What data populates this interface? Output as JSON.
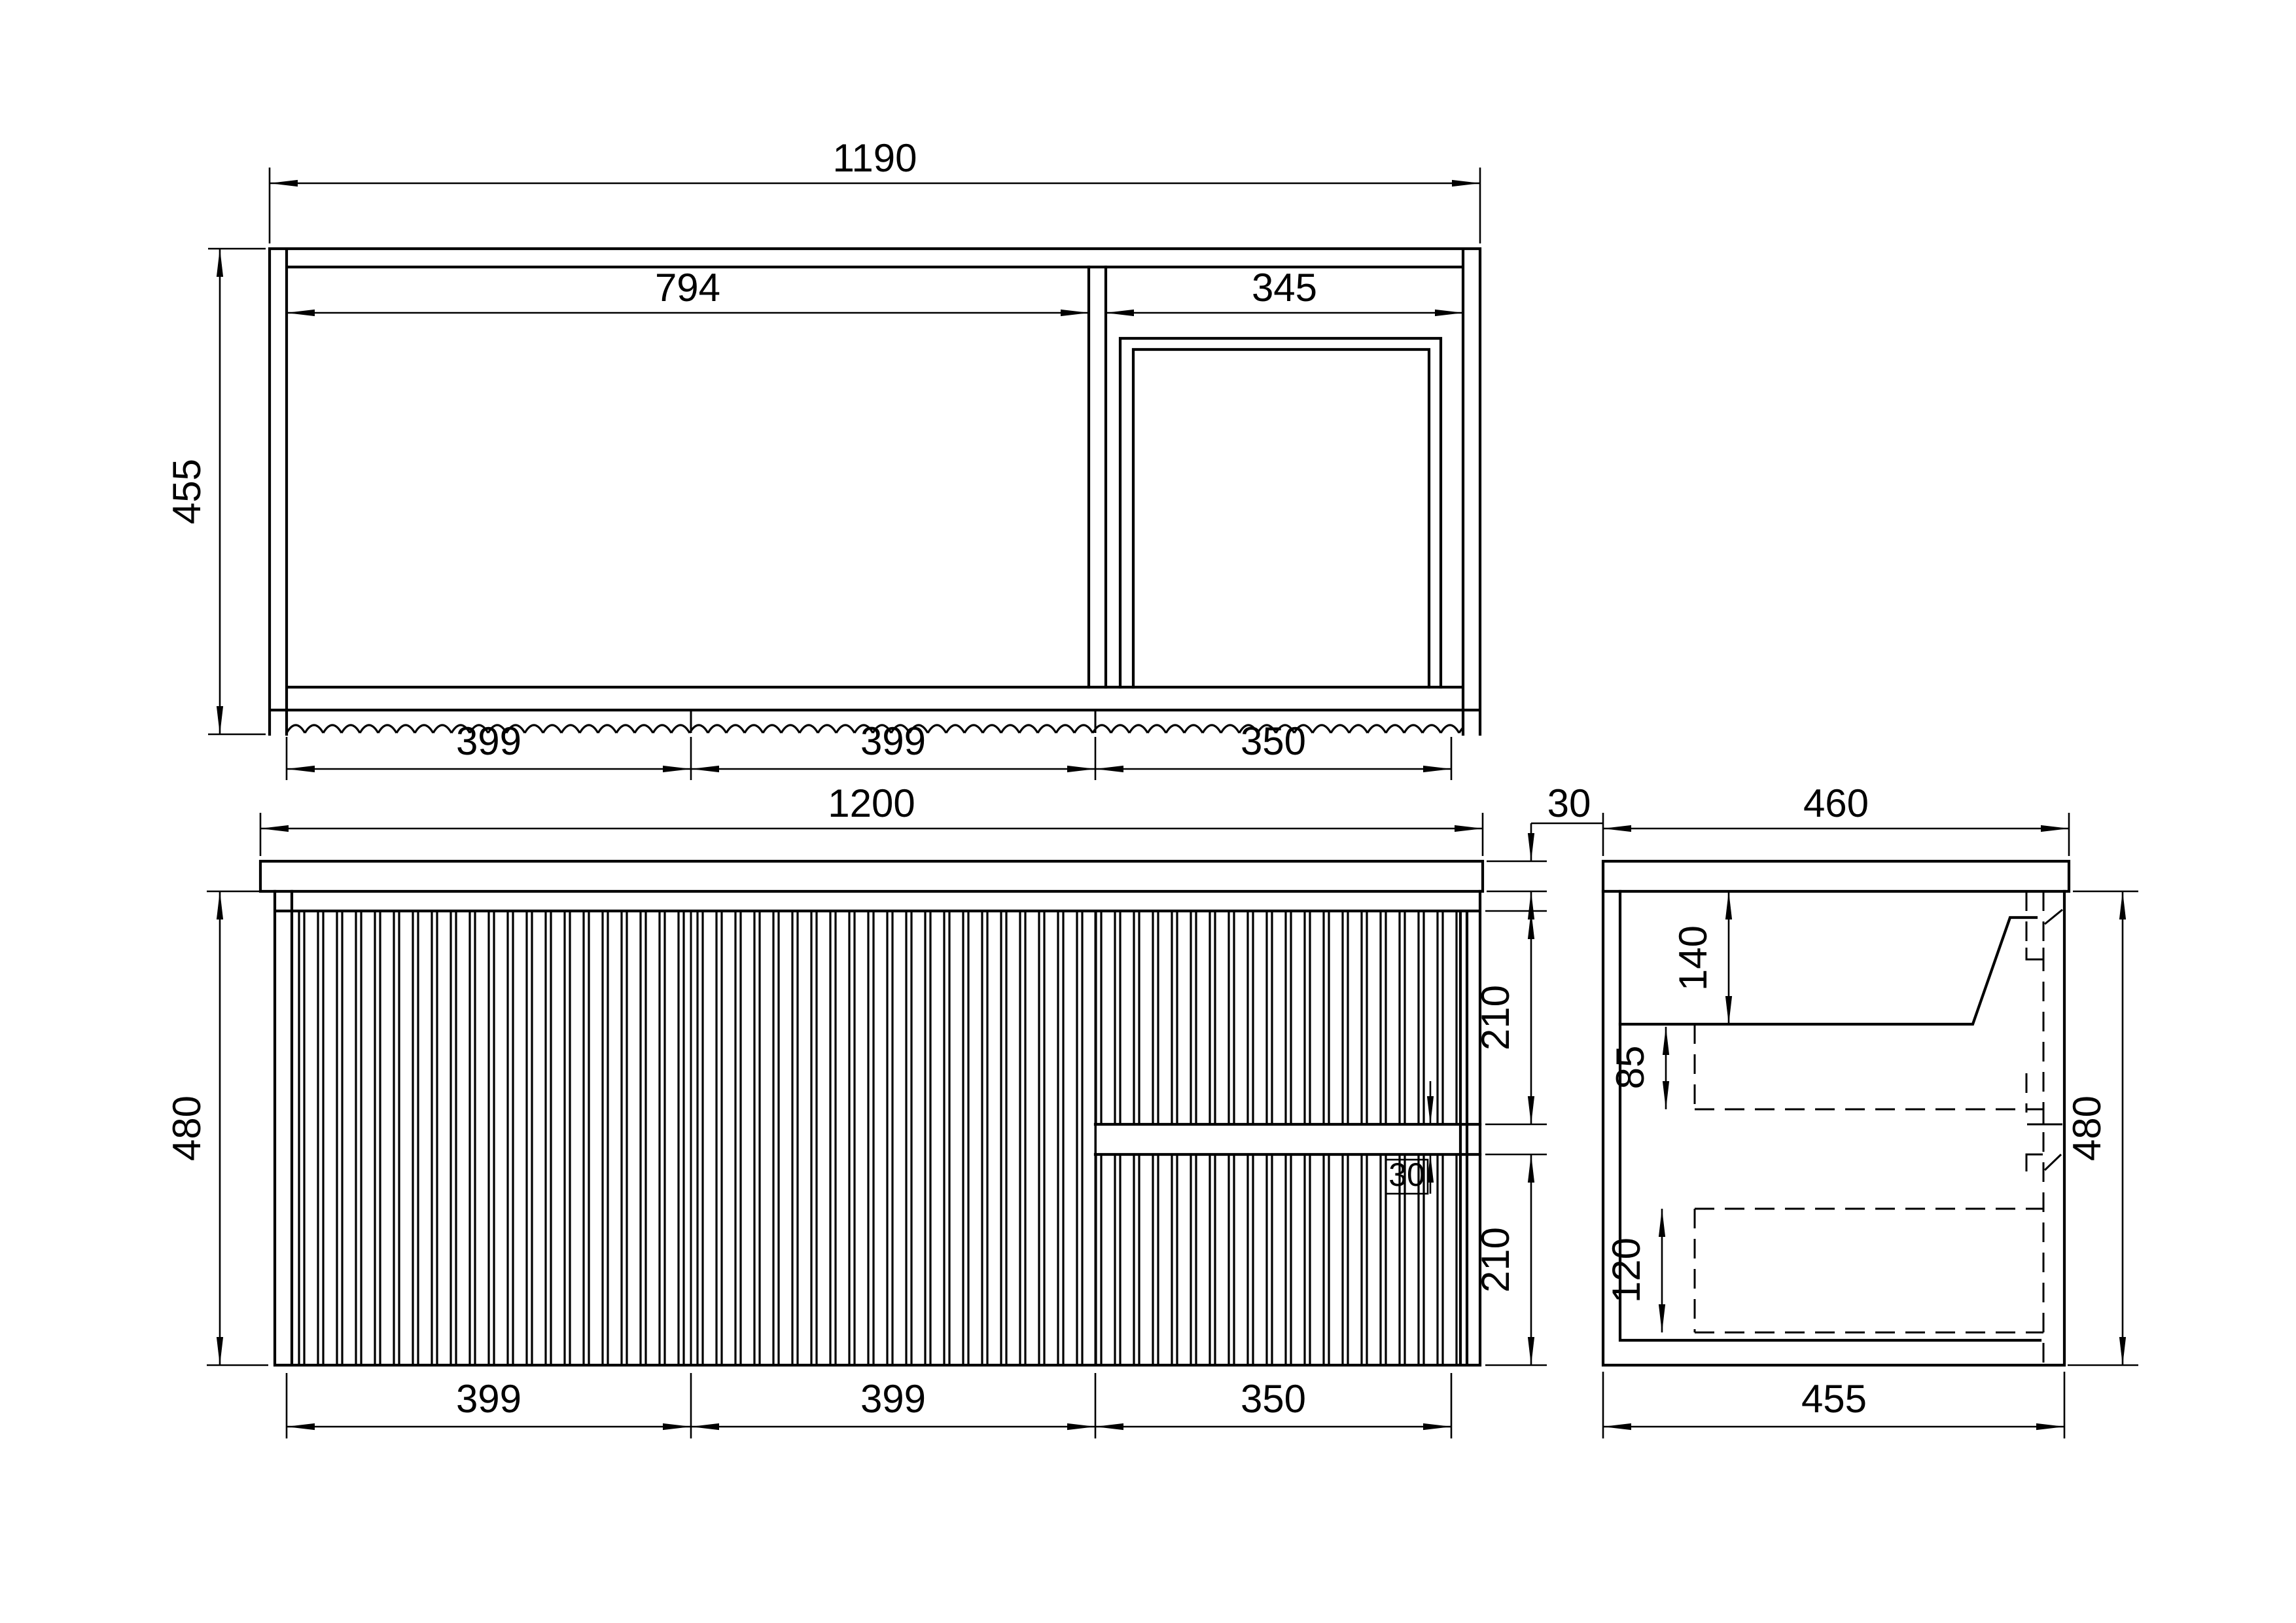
{
  "drawing": {
    "style": {
      "line_color": "#000000",
      "background": "#ffffff"
    },
    "views": {
      "plan": {
        "dims": {
          "overall_width": "1190",
          "opening_left": "794",
          "opening_right": "345",
          "depth": "455",
          "segment_left": "399",
          "segment_mid": "399",
          "segment_right": "350"
        }
      },
      "front": {
        "dims": {
          "overall_width": "1200",
          "benchtop_thickness": "30",
          "height": "480",
          "top_drawer_height": "210",
          "drawer_gap": "30",
          "bottom_drawer_height": "210",
          "segment_left": "399",
          "segment_mid": "399",
          "segment_right": "350"
        }
      },
      "side": {
        "dims": {
          "benchtop_depth": "460",
          "basin_depth": "140",
          "basin_to_drawer": "85",
          "drawer_inner_depth": "120",
          "height": "480",
          "carcass_depth": "455"
        }
      }
    }
  }
}
